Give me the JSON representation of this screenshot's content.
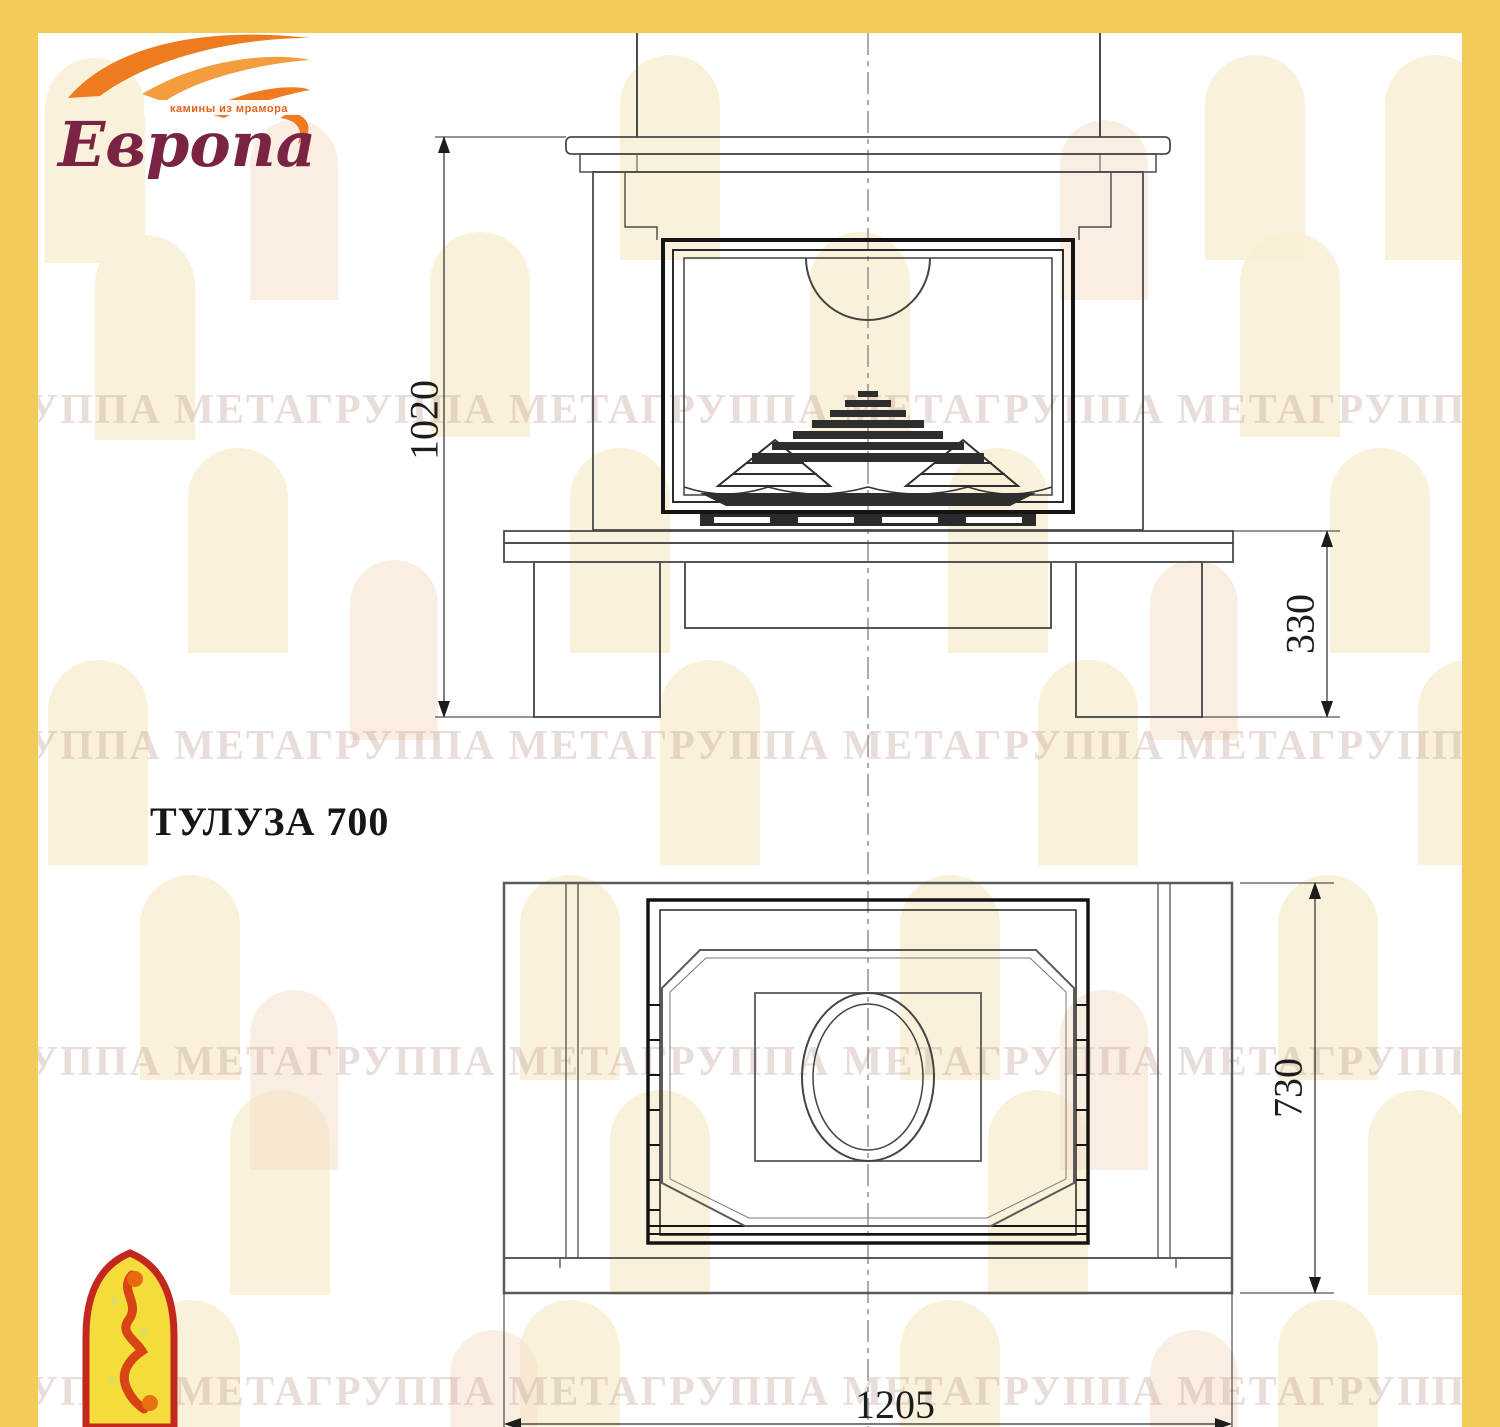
{
  "frame": {
    "color": "#F2CB5B"
  },
  "logo": {
    "brand": "Европа",
    "tagline": "камины из мрамора"
  },
  "title": "ТУЛУЗА 700",
  "watermark": {
    "text": "ГРУППА МЕТАГРУППА МЕТАГРУППА МЕТАГРУППА МЕТАГРУППА МЕТАГРУППА МЕТА"
  },
  "drawing": {
    "front_view": {
      "height_mm": "1020",
      "plinth_height_mm": "330"
    },
    "plan_view": {
      "depth_mm": "730",
      "width_mm": "1205"
    }
  }
}
